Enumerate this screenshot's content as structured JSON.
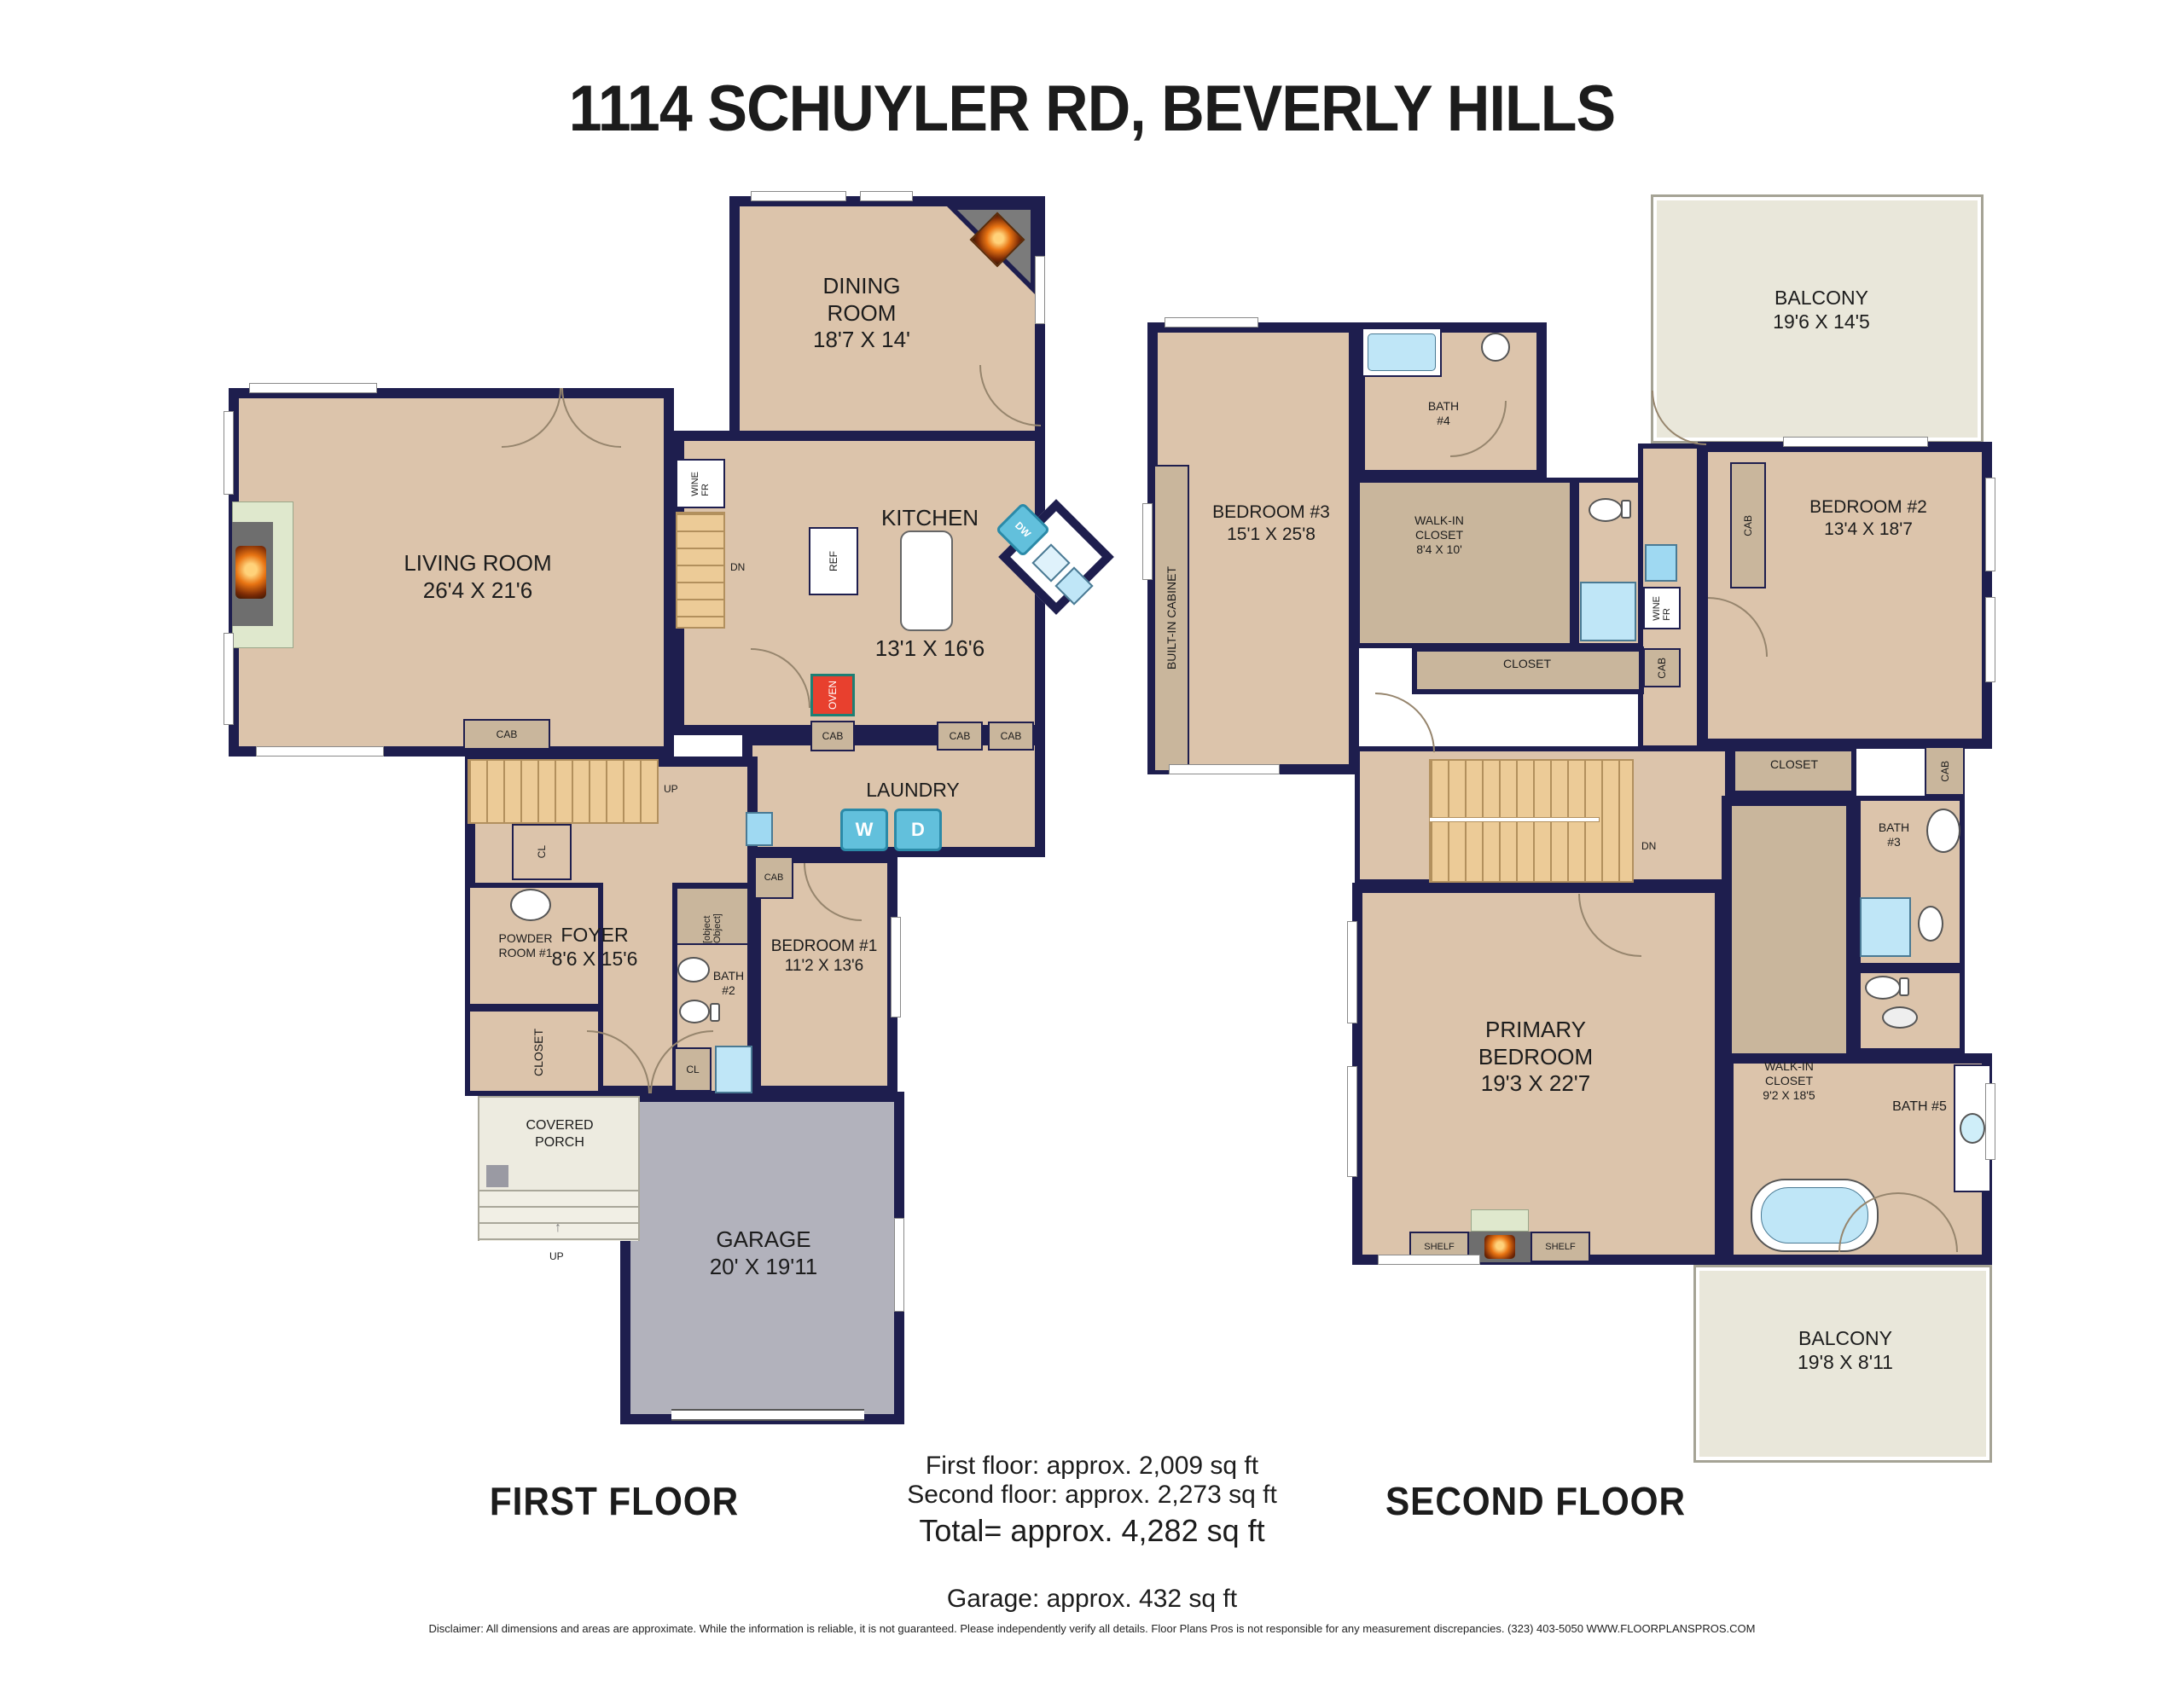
{
  "title": "1114 SCHUYLER RD, BEVERLY HILLS",
  "colors": {
    "wall": "#1e1e4e",
    "floor": "#dcc4ab",
    "taupe": "#c9b69c",
    "stairs": "#eccb97",
    "garage": "#b2b2bc",
    "balcony": "#e9e7da",
    "porch": "#edebe0",
    "blue": "#bfe6f7",
    "teal": "#62c0dc",
    "oven": "#e8402e"
  },
  "ff": {
    "label": "FIRST FLOOR",
    "living": {
      "name": "LIVING ROOM",
      "dims": "26'4 X 21'6"
    },
    "dining": {
      "name": "DINING\nROOM",
      "dims": "18'7 X 14'"
    },
    "kitchen": {
      "name": "KITCHEN",
      "dims": "13'1 X 16'6"
    },
    "laundry": {
      "name": "LAUNDRY"
    },
    "foyer": {
      "name": "FOYER",
      "dims": "8'6 X 15'6"
    },
    "powder": {
      "name": "POWDER\nROOM  #1"
    },
    "bedroom1": {
      "name": "BEDROOM #1",
      "dims": "11'2 X 13'6"
    },
    "bath2": {
      "name": "BATH\n#2"
    },
    "walkin": {
      "name": "WALK-IN\nCLOSET"
    },
    "closet": {
      "name": "CLOSET"
    },
    "cl": "CL",
    "porch": {
      "name": "COVERED\nPORCH"
    },
    "garage": {
      "name": "GARAGE",
      "dims": "20' X 19'11"
    },
    "up": "UP",
    "dn": "DN",
    "cab": "CAB",
    "ref": "REF",
    "oven": "OVEN",
    "wine": "WINE\nFR",
    "dw": "DW",
    "washer": "W",
    "dryer": "D",
    "up_arrow": "↑"
  },
  "sf": {
    "label": "SECOND FLOOR",
    "balcony_top": {
      "name": "BALCONY",
      "dims": "19'6 X 14'5"
    },
    "bedroom3": {
      "name": "BEDROOM #3",
      "dims": "15'1 X 25'8"
    },
    "builtin": "BUILT-IN CABINET",
    "bath4": {
      "name": "BATH\n#4"
    },
    "walkin84": {
      "name": "WALK-IN\nCLOSET",
      "dims": "8'4 X 10'"
    },
    "closet_mid": "CLOSET",
    "bedroom2": {
      "name": "BEDROOM #2",
      "dims": "13'4 X 18'7"
    },
    "closet_stair": "CLOSET",
    "walkin92": {
      "name": "WALK-IN\nCLOSET",
      "dims": "9'2 X 18'5"
    },
    "bath3": {
      "name": "BATH\n#3"
    },
    "primary": {
      "name": "PRIMARY\nBEDROOM",
      "dims": "19'3 X 22'7"
    },
    "bath5": "BATH #5",
    "shelf": "SHELF",
    "balcony_bottom": {
      "name": "BALCONY",
      "dims": "19'8 X 8'11"
    },
    "cab": "CAB",
    "wine": "WINE\nFR",
    "dn": "DN"
  },
  "footer": {
    "first": "First floor: approx. 2,009 sq ft",
    "second": "Second floor: approx. 2,273 sq ft",
    "total": "Total= approx. 4,282 sq ft",
    "garage": "Garage: approx. 432 sq ft",
    "disclaimer": "Disclaimer: All dimensions and areas are approximate. While the information is reliable, it is not guaranteed. Please independently verify all details. Floor Plans Pros is not responsible for any measurement discrepancies. (323) 403-5050 WWW.FLOORPLANSPROS.COM"
  }
}
